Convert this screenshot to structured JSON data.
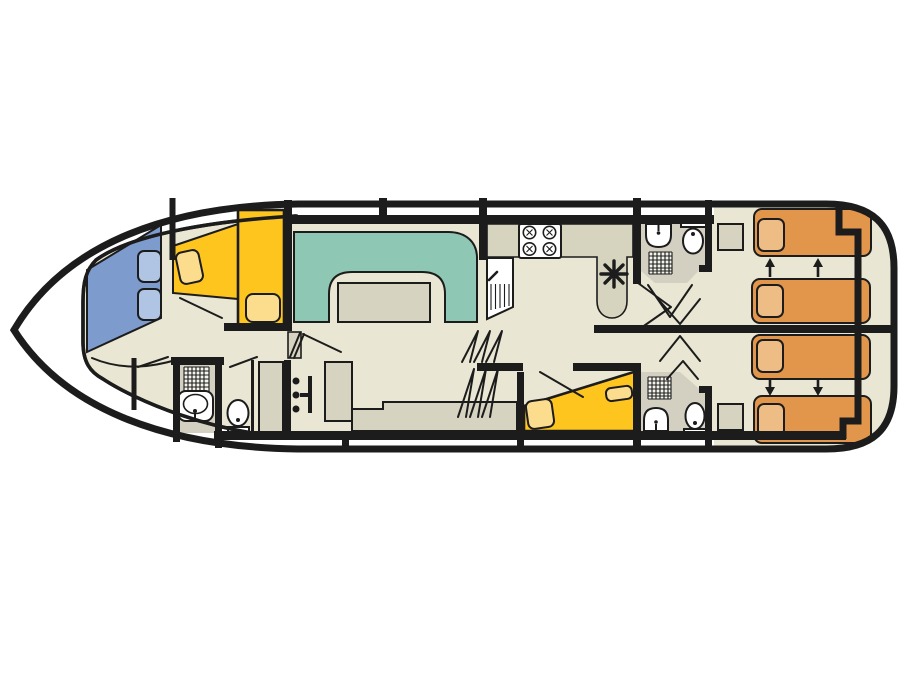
{
  "diagram": {
    "type": "boat-deck-plan",
    "view": "top-down",
    "orientation": "bow-left"
  },
  "colors": {
    "hull": "#1c1c1c",
    "white": "#ffffff",
    "floor_light": "#e9e6d3",
    "floor_bath": "#d3d0c2",
    "counter": "#d6d3bf",
    "furniture": "#d6d3c1",
    "teal": "#8fc7b5",
    "yellow": "#fdc51e",
    "yellow_light": "#fcdc8d",
    "blue": "#7e9bcd",
    "blue_light": "#b0c5e3",
    "orange": "#e2964b",
    "orange_light": "#eebd85"
  },
  "areas": [
    {
      "id": "bow-cabin",
      "label": "bow cabin with angled berths"
    },
    {
      "id": "bow-bathroom",
      "label": "bow bathroom with shower, washbasin and toilet"
    },
    {
      "id": "saloon",
      "label": "saloon with U-shaped dinette, table and inside helm"
    },
    {
      "id": "galley",
      "label": "galley with 4-burner stove and sink unit"
    },
    {
      "id": "mid-cabin",
      "label": "middle double cabin"
    },
    {
      "id": "aft-bathroom-top",
      "label": "aft bathroom (top) with washbasin, toilet and shower"
    },
    {
      "id": "aft-bathroom-bottom",
      "label": "aft bathroom (bottom) with shower, washbasin and toilet"
    },
    {
      "id": "aft-cabin-top",
      "label": "aft cabin with two sliding single beds"
    },
    {
      "id": "aft-cabin-bottom",
      "label": "aft cabin with two sliding single beds"
    }
  ],
  "fixtures": [
    {
      "icon": "stove-icon",
      "burners": 4
    },
    {
      "icon": "sink-icon",
      "count": 4
    },
    {
      "icon": "toilet-icon",
      "count": 3
    },
    {
      "icon": "shower-icon",
      "count": 3
    },
    {
      "icon": "stairs-icon",
      "count": 3
    },
    {
      "icon": "helm-icon",
      "count": 1
    },
    {
      "icon": "dinette-table-icon",
      "count": 1
    },
    {
      "icon": "slide-arrow-icon",
      "count": 4
    },
    {
      "icon": "vent-asterisk-icon",
      "count": 1
    }
  ]
}
